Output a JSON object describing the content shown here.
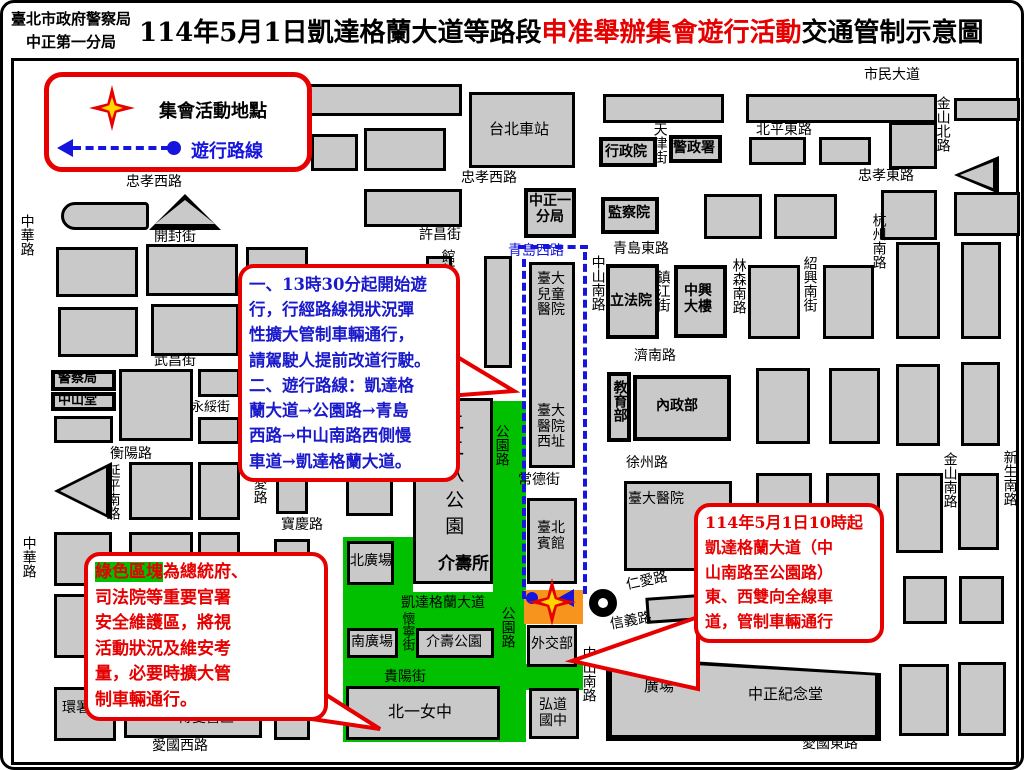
{
  "header": {
    "agency_line1": "臺北市政府警察局",
    "agency_line2": "中正第一分局",
    "title_prefix": "114年5月1日凱達格蘭大道等路段",
    "title_highlight": "申准舉辦集會遊行活動",
    "title_suffix": "交通管制示意圖"
  },
  "legend": {
    "assembly_label": "集會活動地點",
    "route_label": "遊行路線"
  },
  "callouts": {
    "march_info": {
      "text": "一、13時30分起開始遊\n行，行經路線視狀況彈\n性擴大管制車輛通行，\n請駕駛人提前改道行駛。\n二、遊行路線：凱達格\n蘭大道→公園路→青島\n西路→中山南路西側慢\n車道→凱達格蘭大道。"
    },
    "green_zone": {
      "highlight": "綠色區塊",
      "text": "為總統府、\n司法院等重要官署\n安全維護區，將視\n活動狀況及維安考\n量，必要時擴大管\n制車輛通行。"
    },
    "control": {
      "text": "114年5月1日10時起\n凱達格蘭大道（中\n山南路至公園路）\n東、西雙向全線車\n道，管制車輛通行"
    }
  },
  "map": {
    "colors": {
      "green": "#00c000",
      "orange": "#f7941d",
      "route_blue": "#1515dd",
      "red": "#e60000",
      "block_gray": "#c9c9c9"
    },
    "greens": [
      [
        487,
        395,
        33,
        207
      ],
      [
        337,
        531,
        70,
        60
      ],
      [
        337,
        586,
        183,
        150
      ],
      [
        520,
        658,
        57,
        26
      ]
    ],
    "orange_zone": [
      518,
      584,
      59,
      34
    ],
    "circle_pos": [
      583,
      583
    ],
    "blocks": [
      [
        88,
        78,
        368,
        32,
        ""
      ],
      [
        463,
        86,
        106,
        76,
        ""
      ],
      [
        597,
        88,
        121,
        29,
        ""
      ],
      [
        740,
        88,
        191,
        29,
        ""
      ],
      [
        948,
        92,
        66,
        23,
        ""
      ],
      [
        305,
        128,
        47,
        37,
        ""
      ],
      [
        358,
        122,
        82,
        43,
        ""
      ],
      [
        593,
        131,
        58,
        30,
        "k"
      ],
      [
        663,
        129,
        53,
        28,
        "k"
      ],
      [
        743,
        131,
        57,
        28,
        ""
      ],
      [
        813,
        131,
        52,
        28,
        ""
      ],
      [
        883,
        116,
        48,
        47,
        ""
      ],
      [
        948,
        150,
        45,
        38,
        "tl"
      ],
      [
        55,
        196,
        88,
        28,
        "rd"
      ],
      [
        143,
        188,
        72,
        36,
        "tu"
      ],
      [
        50,
        241,
        82,
        50,
        ""
      ],
      [
        140,
        238,
        92,
        52,
        ""
      ],
      [
        240,
        241,
        62,
        49,
        ""
      ],
      [
        52,
        301,
        80,
        50,
        ""
      ],
      [
        145,
        298,
        88,
        52,
        ""
      ],
      [
        240,
        298,
        60,
        50,
        ""
      ],
      [
        358,
        183,
        98,
        38,
        ""
      ],
      [
        518,
        182,
        52,
        50,
        "k"
      ],
      [
        595,
        191,
        58,
        37,
        "k"
      ],
      [
        698,
        188,
        58,
        45,
        ""
      ],
      [
        768,
        188,
        63,
        45,
        ""
      ],
      [
        875,
        184,
        56,
        50,
        ""
      ],
      [
        948,
        186,
        66,
        44,
        ""
      ],
      [
        890,
        236,
        44,
        97,
        ""
      ],
      [
        955,
        236,
        40,
        97,
        ""
      ],
      [
        420,
        250,
        26,
        114,
        ""
      ],
      [
        478,
        250,
        28,
        112,
        ""
      ],
      [
        600,
        258,
        53,
        75,
        "k"
      ],
      [
        668,
        259,
        53,
        73,
        "k"
      ],
      [
        742,
        259,
        52,
        74,
        ""
      ],
      [
        817,
        259,
        51,
        74,
        ""
      ],
      [
        523,
        256,
        46,
        206,
        ""
      ],
      [
        601,
        366,
        24,
        70,
        "k"
      ],
      [
        627,
        369,
        98,
        66,
        "k"
      ],
      [
        750,
        362,
        54,
        76,
        ""
      ],
      [
        823,
        362,
        51,
        76,
        ""
      ],
      [
        890,
        358,
        44,
        82,
        ""
      ],
      [
        955,
        356,
        39,
        84,
        ""
      ],
      [
        618,
        475,
        108,
        90,
        ""
      ],
      [
        750,
        467,
        56,
        80,
        ""
      ],
      [
        820,
        467,
        54,
        80,
        ""
      ],
      [
        890,
        467,
        47,
        80,
        ""
      ],
      [
        952,
        467,
        41,
        77,
        ""
      ],
      [
        897,
        570,
        44,
        48,
        ""
      ],
      [
        953,
        570,
        45,
        48,
        ""
      ],
      [
        640,
        584,
        225,
        26,
        "w"
      ],
      [
        600,
        638,
        275,
        97,
        "mh"
      ],
      [
        893,
        658,
        50,
        72,
        ""
      ],
      [
        952,
        656,
        48,
        74,
        ""
      ],
      [
        45,
        364,
        65,
        21,
        "k"
      ],
      [
        45,
        386,
        65,
        19,
        "k"
      ],
      [
        113,
        363,
        74,
        72,
        ""
      ],
      [
        192,
        363,
        42,
        28,
        ""
      ],
      [
        192,
        411,
        42,
        27,
        ""
      ],
      [
        48,
        410,
        59,
        27,
        ""
      ],
      [
        48,
        456,
        58,
        58,
        "tl"
      ],
      [
        123,
        456,
        64,
        58,
        ""
      ],
      [
        192,
        456,
        42,
        58,
        ""
      ],
      [
        270,
        454,
        32,
        54,
        ""
      ],
      [
        48,
        526,
        58,
        54,
        ""
      ],
      [
        123,
        526,
        64,
        54,
        ""
      ],
      [
        192,
        526,
        42,
        54,
        ""
      ],
      [
        268,
        533,
        36,
        162,
        ""
      ],
      [
        123,
        588,
        64,
        64,
        ""
      ],
      [
        192,
        588,
        42,
        64,
        ""
      ],
      [
        48,
        588,
        58,
        64,
        ""
      ],
      [
        48,
        681,
        62,
        54,
        ""
      ],
      [
        118,
        688,
        138,
        44,
        ""
      ],
      [
        268,
        696,
        36,
        38,
        ""
      ],
      [
        341,
        535,
        47,
        44,
        ""
      ],
      [
        407,
        392,
        80,
        186,
        ""
      ],
      [
        341,
        622,
        51,
        30,
        ""
      ],
      [
        410,
        622,
        78,
        30,
        ""
      ],
      [
        340,
        680,
        154,
        54,
        ""
      ],
      [
        521,
        619,
        50,
        42,
        ""
      ],
      [
        523,
        682,
        50,
        51,
        ""
      ],
      [
        521,
        492,
        50,
        86,
        ""
      ],
      [
        340,
        400,
        47,
        52,
        ""
      ],
      [
        340,
        463,
        47,
        47,
        ""
      ]
    ],
    "texts": [
      {
        "t": "市民大道",
        "x": 858,
        "y": 62
      },
      {
        "t": "忠孝西路",
        "x": 120,
        "y": 169
      },
      {
        "t": "忠孝西路",
        "x": 455,
        "y": 165
      },
      {
        "t": "北平東路",
        "x": 750,
        "y": 117
      },
      {
        "t": "忠孝東路",
        "x": 852,
        "y": 163
      },
      {
        "t": "金山北路",
        "x": 928,
        "y": 90,
        "v": 1
      },
      {
        "t": "開封街",
        "x": 148,
        "y": 224
      },
      {
        "t": "許昌街",
        "x": 413,
        "y": 222
      },
      {
        "t": "天津街",
        "x": 645,
        "y": 116,
        "v": 1
      },
      {
        "t": "中華路",
        "x": 12,
        "y": 208,
        "v": 1
      },
      {
        "t": "中華路",
        "x": 14,
        "y": 530,
        "v": 1
      },
      {
        "t": "杭州南路",
        "x": 864,
        "y": 207,
        "v": 1
      },
      {
        "t": "青島西路",
        "x": 502,
        "y": 238,
        "c": "#1515dd"
      },
      {
        "t": "青島東路",
        "x": 607,
        "y": 236
      },
      {
        "t": "鎮江街",
        "x": 648,
        "y": 264,
        "v": 1
      },
      {
        "t": "林森南路",
        "x": 724,
        "y": 252,
        "v": 1
      },
      {
        "t": "紹興南街",
        "x": 795,
        "y": 250,
        "v": 1
      },
      {
        "t": "館前路",
        "x": 433,
        "y": 243,
        "v": 1
      },
      {
        "t": "中山南路",
        "x": 583,
        "y": 249,
        "v": 1
      },
      {
        "t": "武昌街",
        "x": 148,
        "y": 348
      },
      {
        "t": "濟南路",
        "x": 628,
        "y": 343
      },
      {
        "t": "襄陽路",
        "x": 327,
        "y": 374
      },
      {
        "t": "永綏街",
        "x": 185,
        "y": 395,
        "fs": 13
      },
      {
        "t": "衡陽路",
        "x": 104,
        "y": 441
      },
      {
        "t": "徐州路",
        "x": 620,
        "y": 450
      },
      {
        "t": "常德街",
        "x": 512,
        "y": 467
      },
      {
        "t": "金山南路",
        "x": 935,
        "y": 446,
        "v": 1
      },
      {
        "t": "新生南路",
        "x": 995,
        "y": 444,
        "v": 1
      },
      {
        "t": "延平南路",
        "x": 98,
        "y": 458,
        "v": 1
      },
      {
        "t": "博愛路",
        "x": 245,
        "y": 456,
        "v": 1
      },
      {
        "t": "寶慶路",
        "x": 275,
        "y": 512
      },
      {
        "t": "公園路",
        "x": 487,
        "y": 418,
        "v": 1
      },
      {
        "t": "公園路",
        "x": 493,
        "y": 600,
        "v": 1
      },
      {
        "t": "臺大醫院",
        "x": 622,
        "y": 486
      },
      {
        "t": "仁愛路",
        "x": 620,
        "y": 568,
        "rot": -12
      },
      {
        "t": "信義路",
        "x": 604,
        "y": 608,
        "rot": -10
      },
      {
        "t": "凱達格蘭大道",
        "x": 395,
        "y": 590
      },
      {
        "t": "重慶南路",
        "x": 302,
        "y": 586,
        "v": 1
      },
      {
        "t": "懷寧街",
        "x": 393,
        "y": 606,
        "v": 1,
        "fs": 13
      },
      {
        "t": "貴陽街",
        "x": 378,
        "y": 664
      },
      {
        "t": "中山南路",
        "x": 574,
        "y": 640,
        "v": 1
      },
      {
        "t": "愛國西路",
        "x": 146,
        "y": 733
      },
      {
        "t": "愛國東路",
        "x": 796,
        "y": 731
      },
      {
        "t": "台北車站",
        "x": 483,
        "y": 115,
        "fs": 15
      },
      {
        "t": "行政院",
        "x": 599,
        "y": 139,
        "b": 1
      },
      {
        "t": "警政署",
        "x": 667,
        "y": 135,
        "b": 1
      },
      {
        "t": "監察院",
        "x": 602,
        "y": 200,
        "b": 1
      },
      {
        "t": "中正一\n分局",
        "x": 523,
        "y": 188,
        "b": 1
      },
      {
        "t": "立法院",
        "x": 604,
        "y": 288,
        "b": 1
      },
      {
        "t": "中興\n大樓",
        "x": 678,
        "y": 278,
        "b": 1
      },
      {
        "t": "臺大\n兒童\n醫院",
        "x": 531,
        "y": 266
      },
      {
        "t": "臺大\n醫院\n西址",
        "x": 531,
        "y": 398
      },
      {
        "t": "教育部",
        "x": 605,
        "y": 374,
        "v": 1,
        "b": 1
      },
      {
        "t": "內政部",
        "x": 650,
        "y": 393,
        "b": 1
      },
      {
        "t": "警察局",
        "x": 52,
        "y": 366,
        "b": 1,
        "fs": 13
      },
      {
        "t": "中山堂",
        "x": 52,
        "y": 388,
        "b": 1,
        "fs": 13
      },
      {
        "t": "二二八公園",
        "x": 436,
        "y": 406,
        "v": 1,
        "fs": 19,
        "ls": 7
      },
      {
        "t": "介壽所",
        "x": 432,
        "y": 549,
        "fs": 17,
        "b": 1
      },
      {
        "t": "北廣場",
        "x": 344,
        "y": 548
      },
      {
        "t": "南廣場",
        "x": 345,
        "y": 629
      },
      {
        "t": "介壽公園",
        "x": 420,
        "y": 629
      },
      {
        "t": "北一女中",
        "x": 382,
        "y": 697,
        "fs": 16
      },
      {
        "t": "臺北\n賓館",
        "x": 531,
        "y": 515
      },
      {
        "t": "外交部",
        "x": 525,
        "y": 631
      },
      {
        "t": "弘道\n國中",
        "x": 533,
        "y": 692
      },
      {
        "t": "總統府",
        "x": 272,
        "y": 550,
        "v": 1,
        "fs": 24,
        "ls": 9
      },
      {
        "t": "環署",
        "x": 56,
        "y": 695
      },
      {
        "t": "博愛營區",
        "x": 172,
        "y": 705
      },
      {
        "t": "自由\n廣場",
        "x": 638,
        "y": 655,
        "fs": 15
      },
      {
        "t": "中正紀念堂",
        "x": 742,
        "y": 680,
        "fs": 15
      }
    ],
    "route": {
      "vlines": [
        [
          516,
          253,
          340
        ],
        [
          577,
          246,
          342
        ]
      ],
      "hlines": [
        [
          512,
          239,
          70
        ],
        [
          532,
          594,
          26
        ]
      ]
    }
  }
}
